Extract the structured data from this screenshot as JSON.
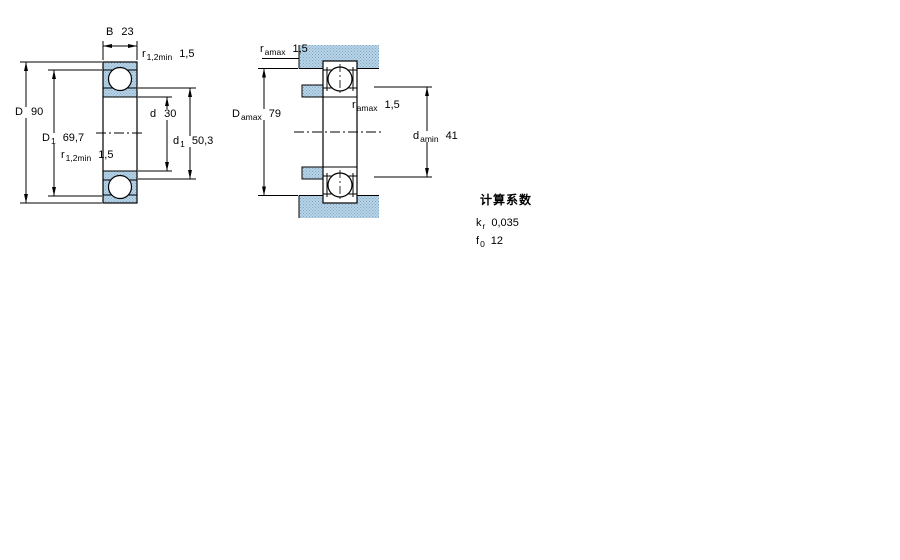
{
  "colors": {
    "section_fill": "#b8d4e6",
    "section_dot": "#7fa9c9",
    "line": "#000000",
    "background": "#ffffff",
    "ball_fill": "#ffffff"
  },
  "drawing_labels": {
    "left": {
      "B": {
        "sym": "B",
        "sub": "",
        "val": "23"
      },
      "r_top": {
        "sym": "r",
        "sub": "1,2min",
        "val": "1,5"
      },
      "D": {
        "sym": "D",
        "sub": "",
        "val": "90"
      },
      "D1": {
        "sym": "D",
        "sub": "1",
        "val": "69,7"
      },
      "r_bottom": {
        "sym": "r",
        "sub": "1,2min",
        "val": "1,5"
      },
      "d": {
        "sym": "d",
        "sub": "",
        "val": "30"
      },
      "d1": {
        "sym": "d",
        "sub": "1",
        "val": "50,3"
      }
    },
    "right": {
      "r_top": {
        "sym": "r",
        "sub": "amax",
        "val": "1,5"
      },
      "Da": {
        "sym": "D",
        "sub": "amax",
        "val": "79"
      },
      "r_mid": {
        "sym": "r",
        "sub": "amax",
        "val": "1,5"
      },
      "da": {
        "sym": "d",
        "sub": "amin",
        "val": "41"
      }
    }
  },
  "calculation_factors": {
    "title": "计算系数",
    "rows": [
      {
        "sym": "k",
        "sub": "r",
        "val": "0,035"
      },
      {
        "sym": "f",
        "sub": "0",
        "val": "12"
      }
    ]
  }
}
